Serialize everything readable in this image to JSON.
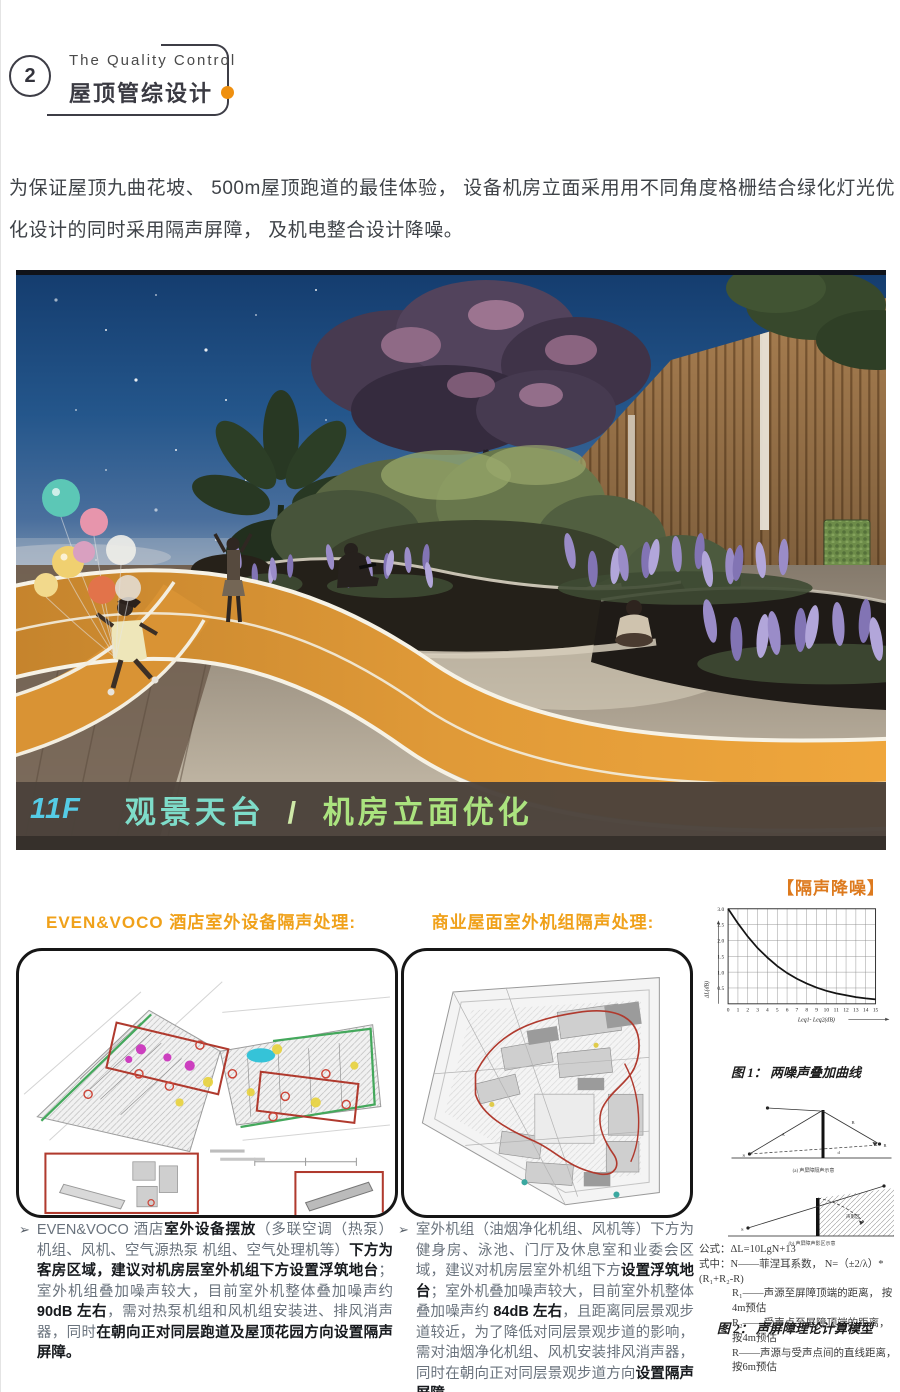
{
  "badge": {
    "number": "2"
  },
  "header": {
    "title_en": "The Quality Control",
    "title_zh": "屋顶管综设计"
  },
  "intro": "为保证屋顶九曲花坡、 500m屋顶跑道的最佳体验， 设备机房立面采用用不同角度格栅结合绿化灯光优化设计的同时采用隔声屏障， 及机电整合设计降噪。",
  "hero": {
    "floor": "11F",
    "caption_main": "观景天台",
    "caption_sep": "/",
    "caption_sub": "机房立面优化"
  },
  "noise_section": {
    "tag": "【隔声降噪】",
    "left_heading": "EVEN&VOCO 酒店室外设备隔声处理:",
    "right_heading": "商业屋面室外机组隔声处理:"
  },
  "chart_data": {
    "type": "line",
    "title": "图 1： 两噪声叠加曲线",
    "xlabel": "Leq1- Leq2(dB)",
    "ylabel": "ΔL(dB)",
    "x": [
      0,
      1,
      2,
      3,
      4,
      5,
      6,
      7,
      8,
      9,
      10,
      11,
      12,
      13,
      14,
      15
    ],
    "y": [
      3.0,
      2.54,
      2.12,
      1.76,
      1.46,
      1.19,
      0.97,
      0.79,
      0.64,
      0.51,
      0.41,
      0.33,
      0.27,
      0.21,
      0.17,
      0.14
    ],
    "xlim": [
      0,
      15
    ],
    "ylim": [
      0,
      3
    ],
    "x_ticks": [
      0,
      1,
      2,
      3,
      4,
      5,
      6,
      7,
      8,
      9,
      10,
      11,
      12,
      13,
      14,
      15
    ],
    "y_ticks": [
      0.5,
      1.0,
      1.5,
      2.0,
      2.5,
      3.0
    ],
    "grid": true,
    "legend": "none"
  },
  "figure2": {
    "formula_label": "公式：",
    "formula": "ΔL=10LgN+13",
    "where_label": "式中：",
    "lines": [
      "N——菲涅耳系数， N=（±2/λ）*(R₁+R₂-R)",
      "R₁——声源至屏障顶端的距离， 按4m预估",
      "R₂——受声点至屏障顶端的距离， 按4m预估",
      "R——声源与受声点间的直线距离， 按6m预估"
    ],
    "caption": "图 2： 声屏障理论计算模型",
    "diagram": {
      "s": "S",
      "r": "R",
      "a": "A",
      "b": "B",
      "d": "d",
      "zone": "声影区",
      "caption_a": "(a) 声屏障隔声示意",
      "caption_b": "(b) 声屏障声影区示意"
    }
  },
  "bullets": {
    "marker": "➢",
    "left": [
      {
        "t": "EVEN&VOCO 酒店",
        "b": false
      },
      {
        "t": "室外设备摆放",
        "b": true
      },
      {
        "t": "（多联空调（热泵）机组、风机、空气源热泵 机组、空气处理机等）",
        "b": false
      },
      {
        "t": "下方为客房区域，建议对机房层室外机组下方设置浮筑地台",
        "b": true
      },
      {
        "t": "；室外机组叠加噪声较大，目前室外机整体叠加噪声约 ",
        "b": false
      },
      {
        "t": "90dB 左右",
        "b": true
      },
      {
        "t": "，需对热泵机组和风机组安装进、排风消声器，同时",
        "b": false
      },
      {
        "t": "在朝向正对同层跑道及屋顶花园方向设置隔声屏障。",
        "b": true
      }
    ],
    "right": [
      {
        "t": "室外机组（油烟净化机组、风机等）下方为健身房、泳池、门厅及休息室和业委会区域，建议对机房层室外机组下方",
        "b": false
      },
      {
        "t": "设置浮筑地台",
        "b": true
      },
      {
        "t": "；室外机叠加噪声较大，目前室外机整体叠加噪声约 ",
        "b": false
      },
      {
        "t": "84dB 左右",
        "b": true
      },
      {
        "t": "，且距离同层景观步道较近，为了降低对同层景观步道的影响，需对油烟净化机组、风机安装排风消声器，同时在朝向正对同层景观步道方向",
        "b": false
      },
      {
        "t": "设置隔声屏障。",
        "b": true
      }
    ]
  },
  "colors": {
    "accent_orange": "#EF9010",
    "tag_orange": "#DD7A1E",
    "heading_orange": "#F0A11A",
    "caption_cyan": "#55CBE5",
    "caption_teal": "#7EDCC9",
    "caption_green": "#ABE37F",
    "track_orange": "#E09A38",
    "plan_red": "#B03A2E",
    "plan_green": "#44A85C"
  }
}
